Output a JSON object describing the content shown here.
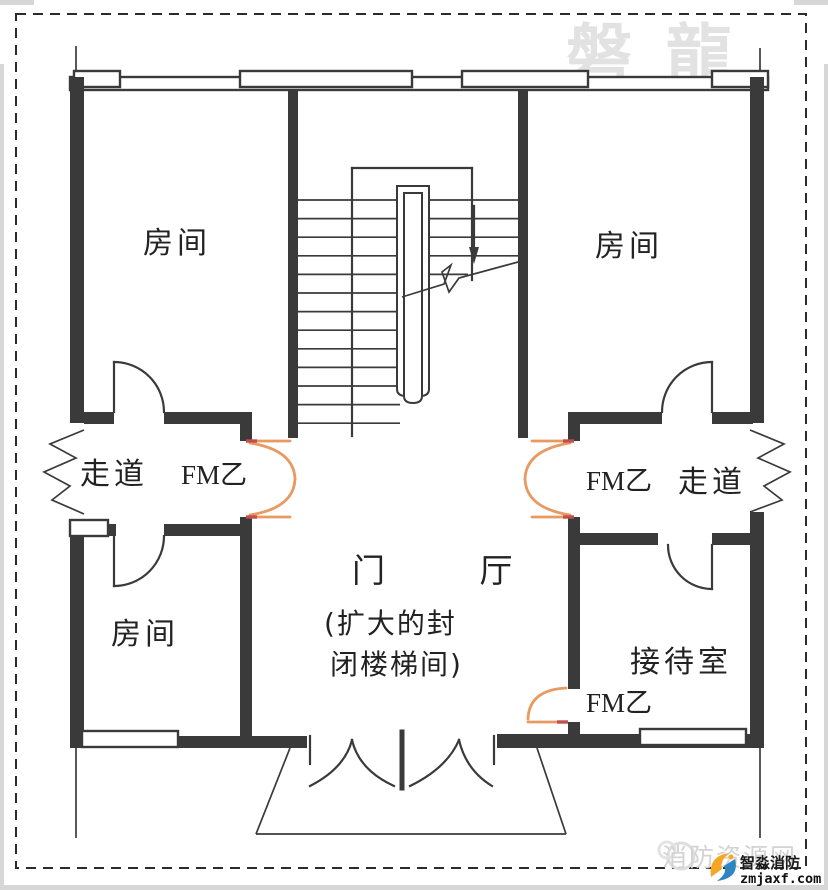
{
  "colors": {
    "wall": "#3a3a3a",
    "line": "#3a3a3a",
    "firedoor": "#e89a62",
    "hinge": "#c0504d",
    "watermark": "#e2e2e2",
    "labelcolor": "#222222",
    "logoorange": "#f5a623",
    "logoblue": "#2e86c1"
  },
  "labels": {
    "room_top_left": "房间",
    "room_top_right": "房间",
    "room_bottom_left": "房间",
    "reception": "接待室",
    "corridor_left": "走道",
    "corridor_right": "走道",
    "hall_title": "门 厅",
    "hall_sub1": "(扩大的封",
    "hall_sub2": "闭楼梯间)",
    "fire_door_left": "FM乙",
    "fire_door_right": "FM乙",
    "fire_door_reception": "FM乙"
  },
  "watermarks": {
    "brand": "磐龍",
    "site": "消防资源网",
    "logo_name": "智淼消防",
    "logo_domain": "zmjaxf.com"
  }
}
